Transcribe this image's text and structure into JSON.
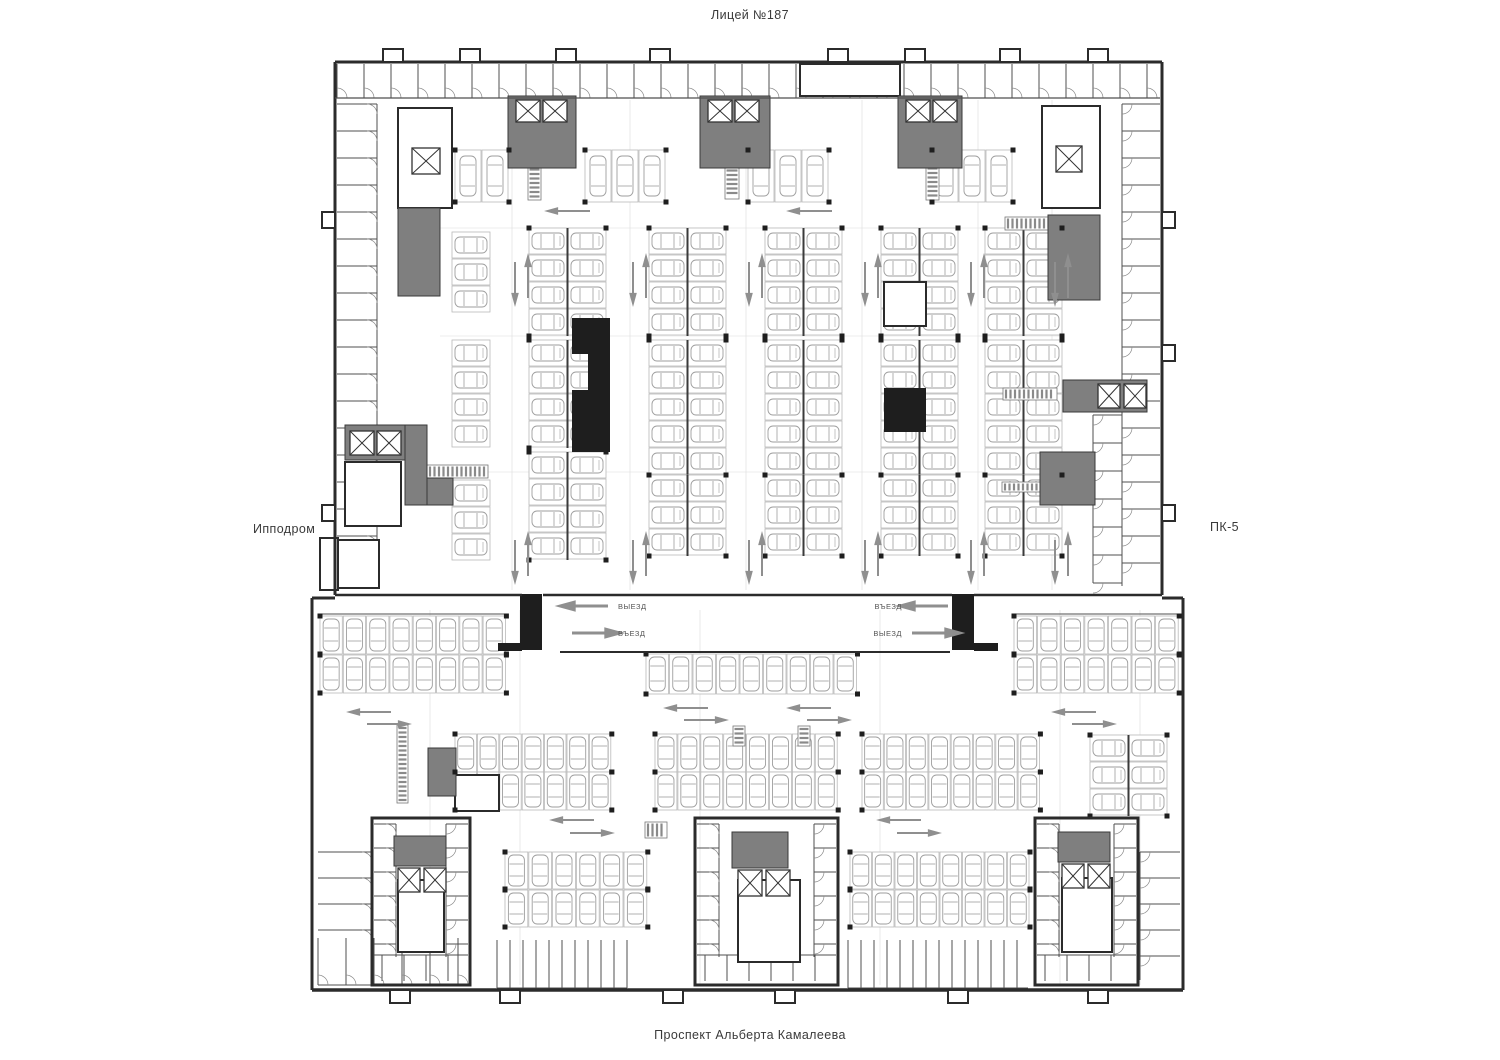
{
  "labels": {
    "top": "Лицей №187",
    "left": "Ипподром",
    "right": "ПК-5",
    "bottom": "Проспект Альберта Камалеева"
  },
  "ramp": {
    "exit_label": "ВЫЕЗД",
    "entrance_label": "ВЪЕЗД"
  },
  "colors": {
    "background": "#ffffff",
    "wall": "#2b2b2b",
    "black_fill": "#1e1e1e",
    "core_gray": "#7f7f7f",
    "stall_line": "#b9b9b9",
    "car_line": "#9e9e9e",
    "thin_line": "#4f4f4f",
    "light_line": "#8a8a8a",
    "grid_line": "#dcdcdc",
    "arrow": "#8f8f8f",
    "ramp_text": "#555555",
    "label_text": "#3a3a3a"
  }
}
